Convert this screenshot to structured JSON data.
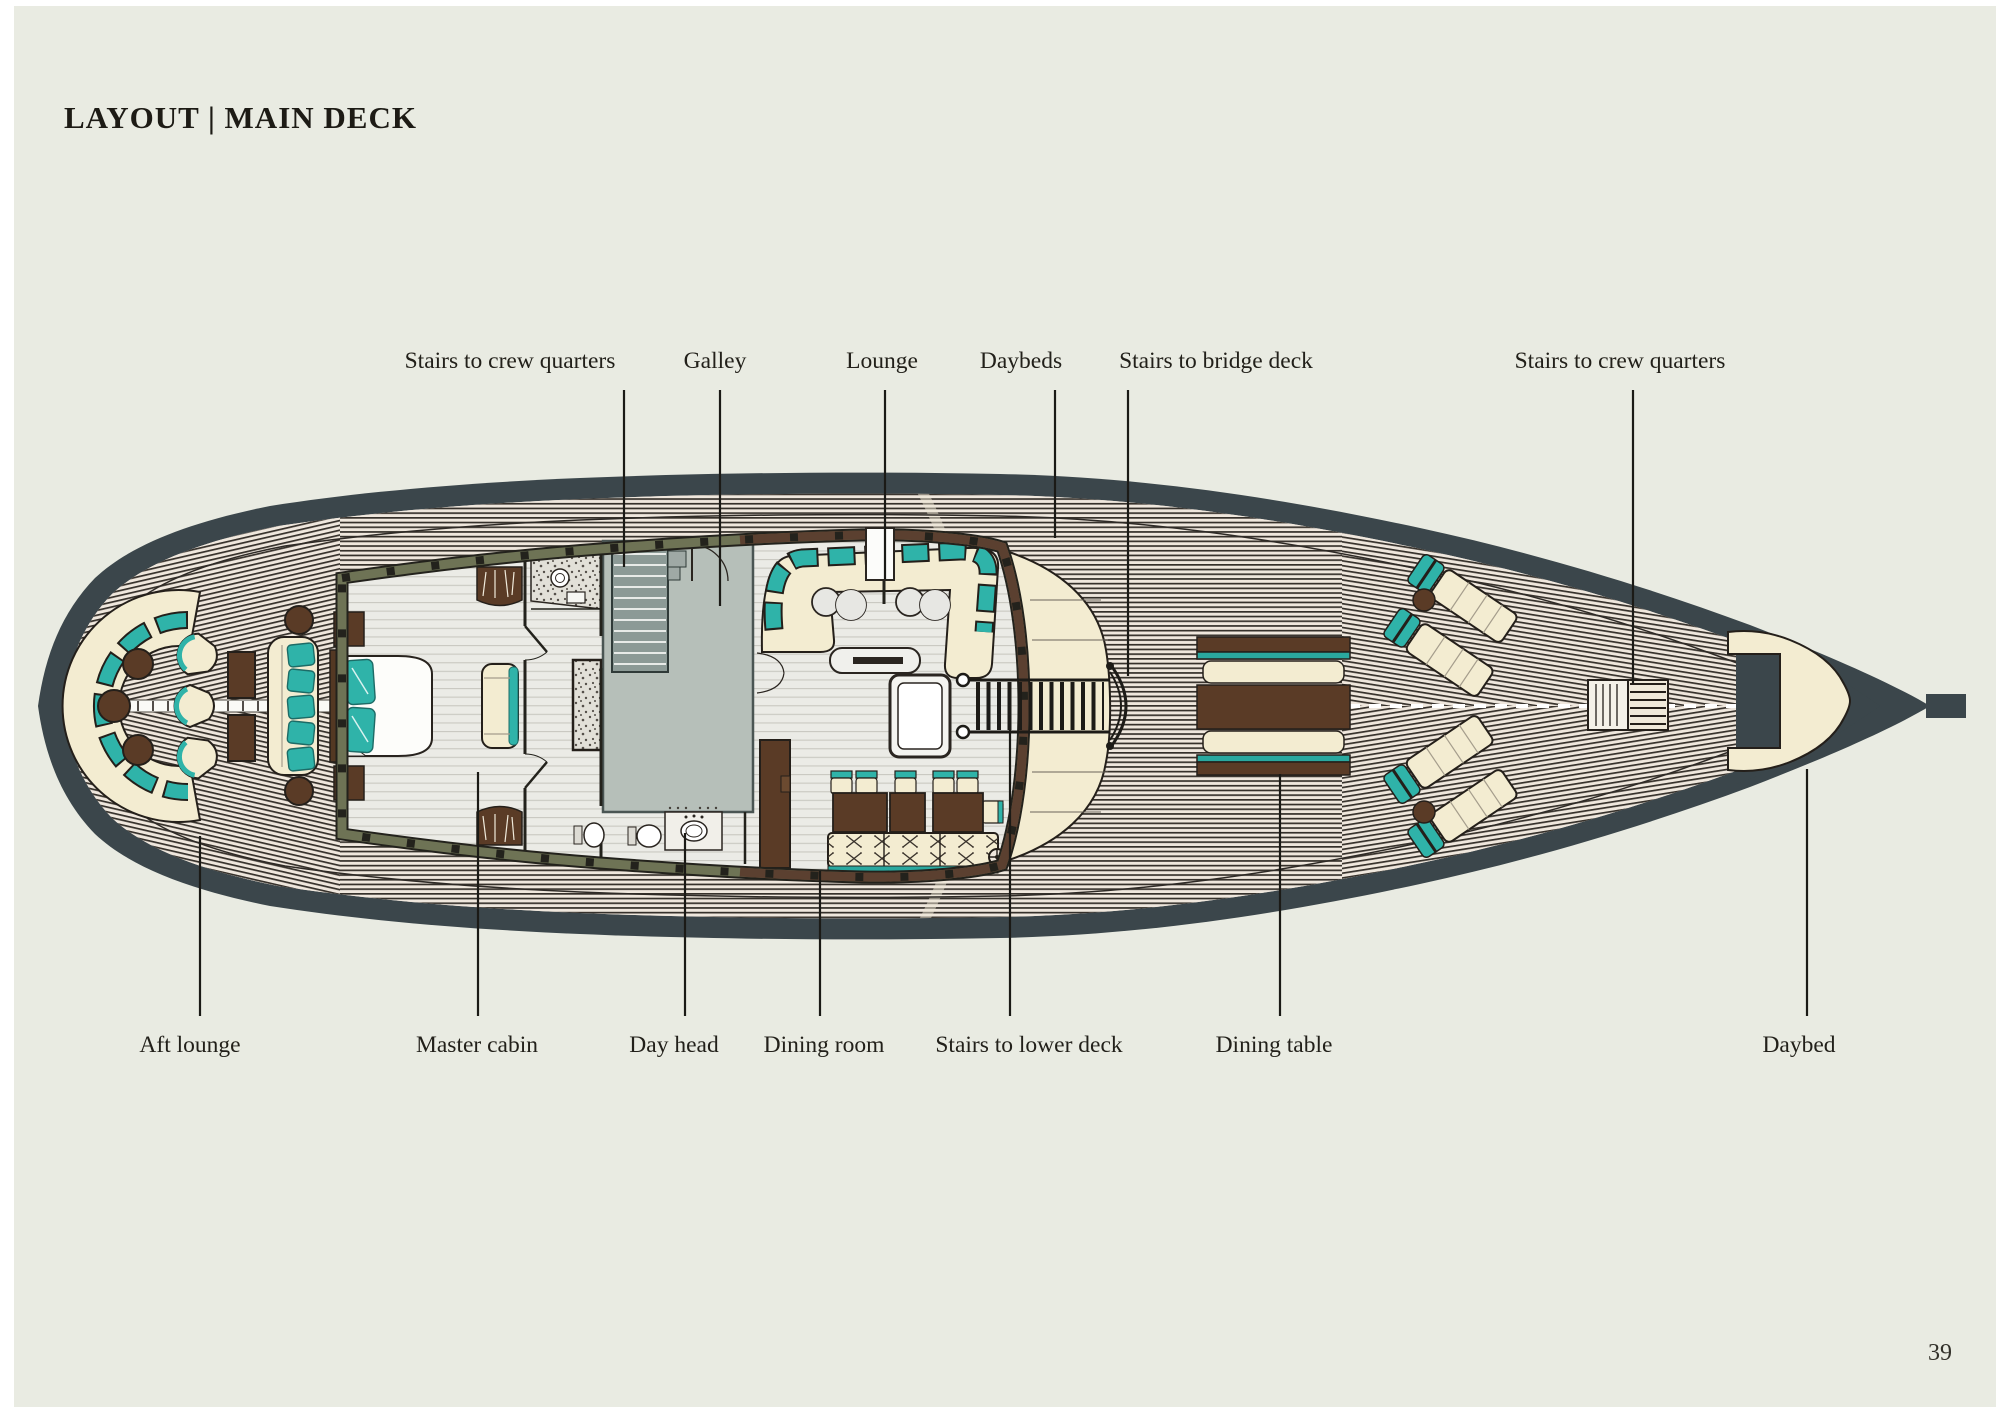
{
  "page": {
    "title": "LAYOUT | MAIN DECK",
    "page_number": "39"
  },
  "diagram": {
    "type": "yacht-deck-floor-plan",
    "deck_name": "Main deck"
  },
  "callouts": {
    "top": [
      "Stairs to crew quarters",
      "Galley",
      "Lounge",
      "Daybeds",
      "Stairs to bridge deck",
      "Stairs to crew quarters"
    ],
    "bottom": [
      "Aft lounge",
      "Master cabin",
      "Day head",
      "Dining room",
      "Stairs to lower deck",
      "Dining table",
      "Daybed"
    ]
  },
  "palette": {
    "page_background": "#e9ebe2",
    "hull_charcoal": "#3b464b",
    "teak_deck": "#efe7dd",
    "plank_line": "#36312b",
    "accent_teal": "#2aa89f",
    "upholstery_cream": "#f3ecd1",
    "wood_brown": "#5a3b26",
    "wall_olive": "#6e7355",
    "wall_mahogany": "#5b4030",
    "galley_gray": "#b6bfb9"
  }
}
